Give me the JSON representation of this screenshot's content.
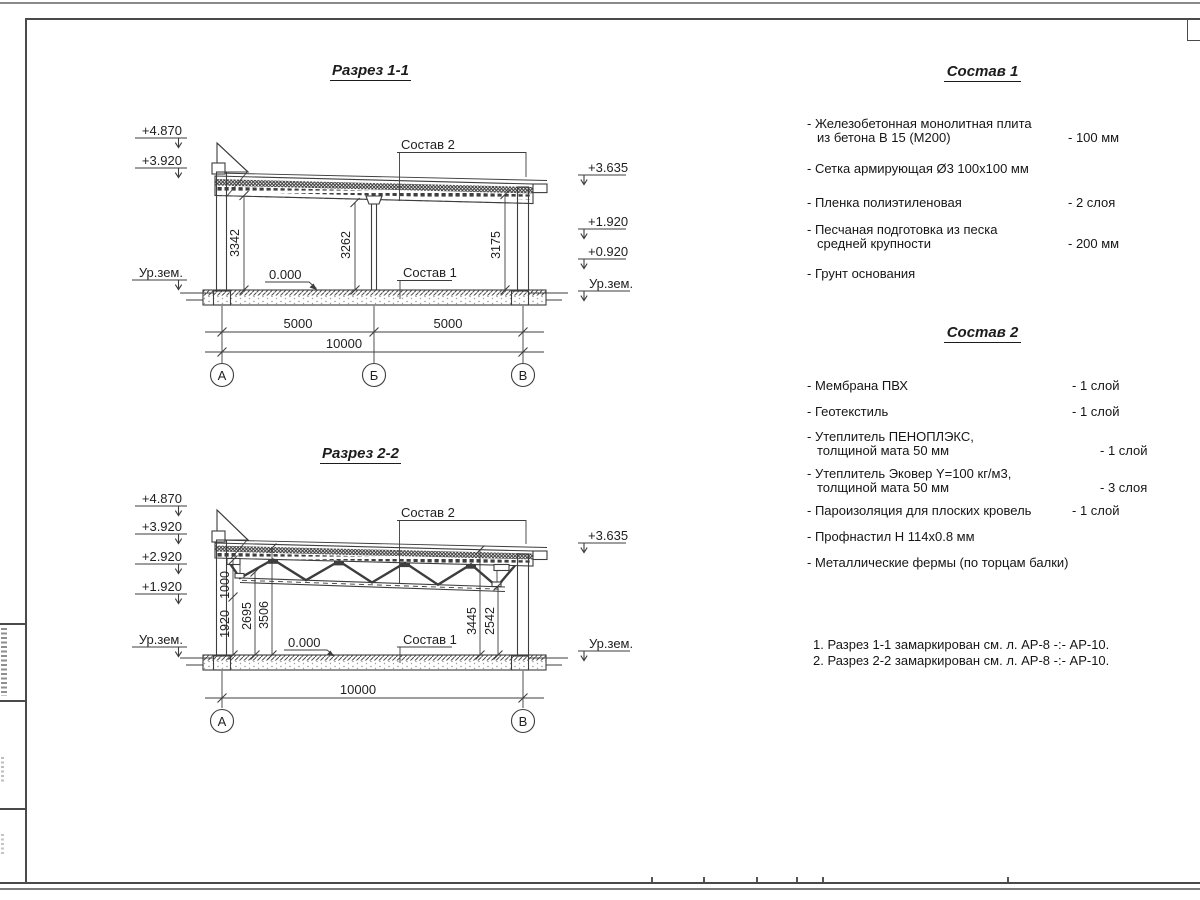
{
  "section1": {
    "title": "Разрез 1-1",
    "elev_4870": "+4.870",
    "elev_3920": "+3.920",
    "ground_left": "Ур.зем.",
    "elev_3635": "+3.635",
    "elev_1920": "+1.920",
    "elev_0920": "+0.920",
    "ground_right": "Ур.зем.",
    "dim_3342": "3342",
    "dim_3262": "3262",
    "dim_3175": "3175",
    "zero": "0.000",
    "leader_top": "Состав 2",
    "leader_bottom": "Состав 1",
    "dim_span1": "5000",
    "dim_span2": "5000",
    "dim_total": "10000",
    "axis_a": "А",
    "axis_b": "Б",
    "axis_v": "В"
  },
  "section2": {
    "title": "Разрез 2-2",
    "elev_4870": "+4.870",
    "elev_3920": "+3.920",
    "elev_2920": "+2.920",
    "elev_1920": "+1.920",
    "ground_left": "Ур.зем.",
    "elev_3635": "+3.635",
    "ground_right": "Ур.зем.",
    "dim_1000": "1000",
    "dim_1920": "1920",
    "dim_2695": "2695",
    "dim_3506": "3506",
    "dim_3445": "3445",
    "dim_2542": "2542",
    "zero": "0.000",
    "leader_top": "Состав 2",
    "leader_bottom": "Состав 1",
    "dim_total": "10000",
    "axis_a": "А",
    "axis_v": "В"
  },
  "spec1": {
    "title": "Состав 1",
    "items": [
      {
        "line1": "- Железобетонная  монолитная плита",
        "line2": "из бетона В 15 (М200)",
        "value": "- 100 мм"
      },
      {
        "line1": "- Сетка армирующая Ø3 100х100 мм",
        "line2": "",
        "value": ""
      },
      {
        "line1": "- Пленка полиэтиленовая",
        "line2": "",
        "value": "-  2 слоя"
      },
      {
        "line1": "- Песчаная подготовка из песка",
        "line2": "средней крупности",
        "value": "- 200 мм"
      },
      {
        "line1": "- Грунт основания",
        "line2": "",
        "value": ""
      }
    ]
  },
  "spec2": {
    "title": "Состав 2",
    "items": [
      {
        "line1": "- Мембрана ПВХ",
        "line2": "",
        "value": "- 1 слой"
      },
      {
        "line1": "- Геотекстиль",
        "line2": "",
        "value": "- 1 слой"
      },
      {
        "line1": "- Утеплитель ПЕНОПЛЭКС,",
        "line2": "толщиной мата 50 мм",
        "value": "- 1 слой"
      },
      {
        "line1": "- Утеплитель Эковер Y=100 кг/м3,",
        "line2": "толщиной мата 50 мм",
        "value": "- 3 слоя"
      },
      {
        "line1": "- Пароизоляция для плоских кровель",
        "line2": "",
        "value": "- 1 слой"
      },
      {
        "line1": "- Профнастил Н 114х0.8 мм",
        "line2": "",
        "value": ""
      },
      {
        "line1": "- Металлические фермы (по торцам балки)",
        "line2": "",
        "value": ""
      }
    ]
  },
  "notes": [
    "1. Разрез 1-1 замаркирован см. л. АР-8 -:- АР-10.",
    "2. Разрез 2-2 замаркирован см. л. АР-8 -:- АР-10."
  ]
}
